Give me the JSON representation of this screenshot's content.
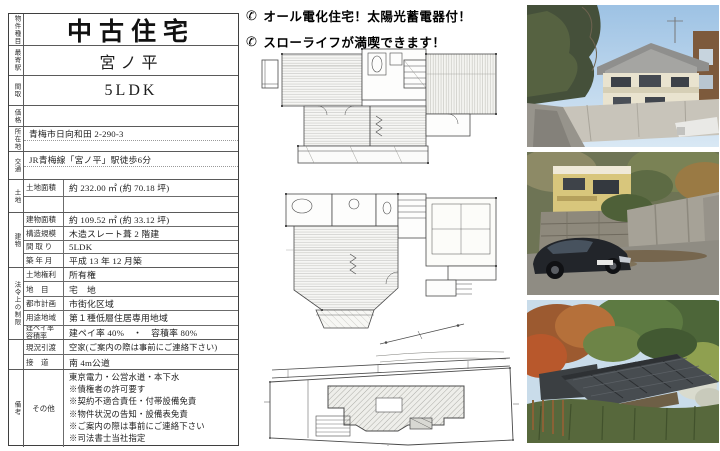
{
  "headlines": {
    "phone_icon": "✆",
    "line1": "オール電化住宅！太陽光蓄電器付！",
    "line2": "スローライフが満喫できます！"
  },
  "spec_table": {
    "property_type": {
      "label": "物件種目",
      "value": "中古住宅"
    },
    "station": {
      "label": "最寄駅",
      "value": "宮ノ平"
    },
    "madori": {
      "label": "間取",
      "value": "5LDK"
    },
    "price": {
      "label": "価格",
      "value": ""
    },
    "address": {
      "label": "所在地",
      "value": "青梅市日向和田 2-290-3"
    },
    "access": {
      "label": "交通",
      "value": "JR青梅線「宮ノ平」駅徒歩6分"
    },
    "land": {
      "group_label": "土地",
      "rows": [
        {
          "label": "土地面積",
          "value": "約 232.00 ㎡ (約 70.18 坪)"
        }
      ]
    },
    "building": {
      "group_label": "建物",
      "rows": [
        {
          "label": "建物面積",
          "value": "約 109.52 ㎡ (約 33.12 坪)"
        },
        {
          "label": "構造規模",
          "value": "木造スレート葺 2 階建"
        },
        {
          "label": "間 取 り",
          "value": "5LDK"
        },
        {
          "label": "築 年 月",
          "value": "平成 13 年 12 月築"
        }
      ]
    },
    "legal": {
      "group_label": "法令上の制限",
      "rows": [
        {
          "label": "土地権利",
          "value": "所有権"
        },
        {
          "label": "地　目",
          "value": "宅　地"
        },
        {
          "label": "都市計画",
          "value": "市街化区域"
        },
        {
          "label": "用途地域",
          "value": "第１種低層住居専用地域"
        },
        {
          "label1": "建ペイ率",
          "label2": "容積率",
          "value": "建ペイ率 40%　・　容積率 80%"
        }
      ]
    },
    "condition": {
      "rows": [
        {
          "label": "現況引渡",
          "value": "空家(ご案内の際は事前にご連絡下さい)"
        },
        {
          "label": "接　道",
          "value": "南 4m公道"
        }
      ]
    },
    "remarks": {
      "group_label": "備考",
      "label": "その他",
      "lines": [
        "東京電力・公営水道・本下水",
        "※債権者の許可要す",
        "※契約不適合責任・付帯設備免責",
        "※物件状況の告知・設備表免責",
        "※ご案内の際は事前にご連絡下さい",
        "※司法書士当社指定"
      ]
    }
  },
  "plans": {
    "panels": [
      "second-floor-plan",
      "first-floor-plan",
      "site-plan"
    ]
  },
  "photos": [
    {
      "name": "house-exterior-photo"
    },
    {
      "name": "parking-and-car-photo"
    },
    {
      "name": "garden-and-roof-photo"
    }
  ],
  "colors": {
    "table_border": "#3f3f3f",
    "plan_line": "#4a4a4a",
    "hatch": "#8a8a8a"
  }
}
